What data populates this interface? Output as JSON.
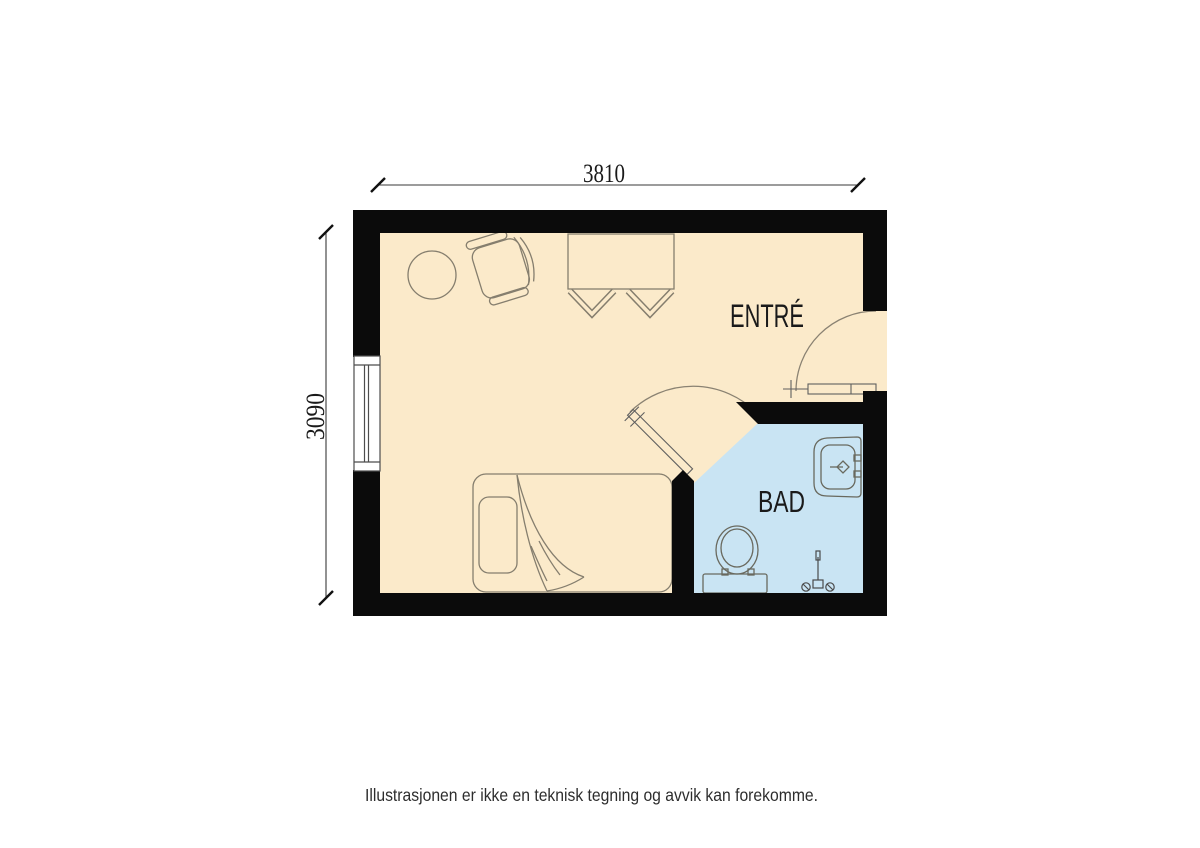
{
  "floorplan": {
    "rooms": [
      {
        "id": "entre",
        "label": "ENTRÉ"
      },
      {
        "id": "bad",
        "label": "BAD"
      }
    ],
    "dimensions": {
      "top": "3810",
      "left": "3090"
    },
    "colors": {
      "floor_main": "#FBEACA",
      "floor_bath": "#C9E4F3",
      "wall": "#0B0B0B"
    },
    "fixtures": [
      "window",
      "entry-door",
      "bathroom-door",
      "round-table",
      "armchair",
      "desk",
      "chair",
      "chair",
      "bed",
      "pillow",
      "toilet",
      "sink",
      "shower-mixer"
    ]
  },
  "footer": {
    "disclaimer": "Illustrasjonen er ikke en teknisk tegning og avvik kan forekomme."
  }
}
